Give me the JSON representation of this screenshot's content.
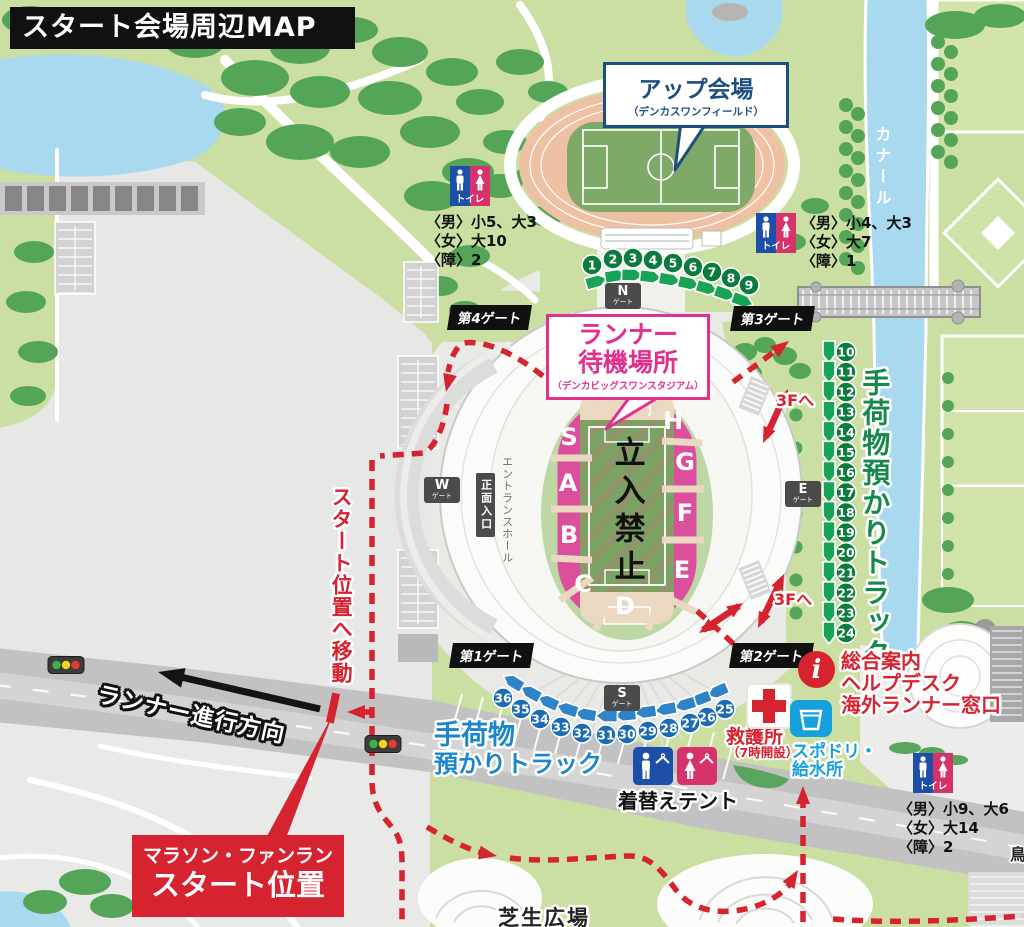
{
  "title": "スタート会場周辺MAP",
  "callouts": {
    "warmup_title": "アップ会場",
    "warmup_sub": "（デンカスワンフィールド）",
    "wait_line1": "ランナー",
    "wait_line2": "待機場所",
    "wait_sub": "（デンカビッグスワンスタジアム）"
  },
  "labels": {
    "canal": "カナール",
    "baggage_right": "手荷物預かりトラック",
    "baggage_bottom1": "手荷物",
    "baggage_bottom2": "預かりトラック",
    "move_to_start": "スタート位置へ移動",
    "runner_direction": "ランナー進行方向",
    "to_3f_upper": "3Fへ",
    "to_3f_lower": "3Fへ",
    "lawn": "芝生広場",
    "edge": "鳥"
  },
  "gates": {
    "g1": "第1ゲート",
    "g2": "第2ゲート",
    "g3": "第3ゲート",
    "g4": "第4ゲート",
    "n": "N",
    "w": "W",
    "e": "E",
    "s": "S",
    "suffix": "ゲート"
  },
  "stadium": {
    "no_entry": "立入禁止",
    "entrance_hall": "エントランスホール",
    "main_entrance": "正面入口",
    "sections": [
      "S",
      "A",
      "B",
      "C",
      "D",
      "E",
      "F",
      "G",
      "H"
    ]
  },
  "toilets": {
    "label": "トイレ",
    "north_west": {
      "men": "〈男〉小5、大3",
      "women": "〈女〉大10",
      "accessible": "〈障〉2"
    },
    "north_east": {
      "men": "〈男〉小4、大3",
      "women": "〈女〉大7",
      "accessible": "〈障〉1"
    },
    "south": {
      "men": "〈男〉小9、大6",
      "women": "〈女〉大14",
      "accessible": "〈障〉2"
    }
  },
  "facilities": {
    "first_aid": "救護所",
    "first_aid_note": "（7時開設）",
    "drink1": "スポドリ・",
    "drink2": "給水所",
    "info_i": "i",
    "info1": "総合案内",
    "info2": "ヘルプデスク",
    "info3": "海外ランナー窓口",
    "changing": "着替えテント"
  },
  "start_box": {
    "line1": "マラソン・ファンラン",
    "line2": "スタート位置"
  },
  "markers": {
    "top_arc": [
      1,
      2,
      3,
      4,
      5,
      6,
      7,
      8,
      9
    ],
    "east_column": [
      10,
      11,
      12,
      13,
      14,
      15,
      16,
      17,
      18,
      19,
      20,
      21,
      22,
      23,
      24
    ],
    "south_arc": [
      25,
      26,
      27,
      28,
      29,
      30,
      31,
      32,
      33,
      34,
      35,
      36
    ]
  },
  "colors": {
    "route_red": "#d5232f",
    "section_pink": "#dc4f9c",
    "callout_pink": "#e0318f",
    "callout_blue": "#1d4e80",
    "baggage_green": "#17894a",
    "baggage_blue": "#1b86c9",
    "drink_cyan": "#18a0dc",
    "toilet_blue": "#1e4fa8",
    "toilet_pink": "#d6336c",
    "marker_green": "#0e7b3e",
    "marker_blue": "#1a6cb3"
  }
}
